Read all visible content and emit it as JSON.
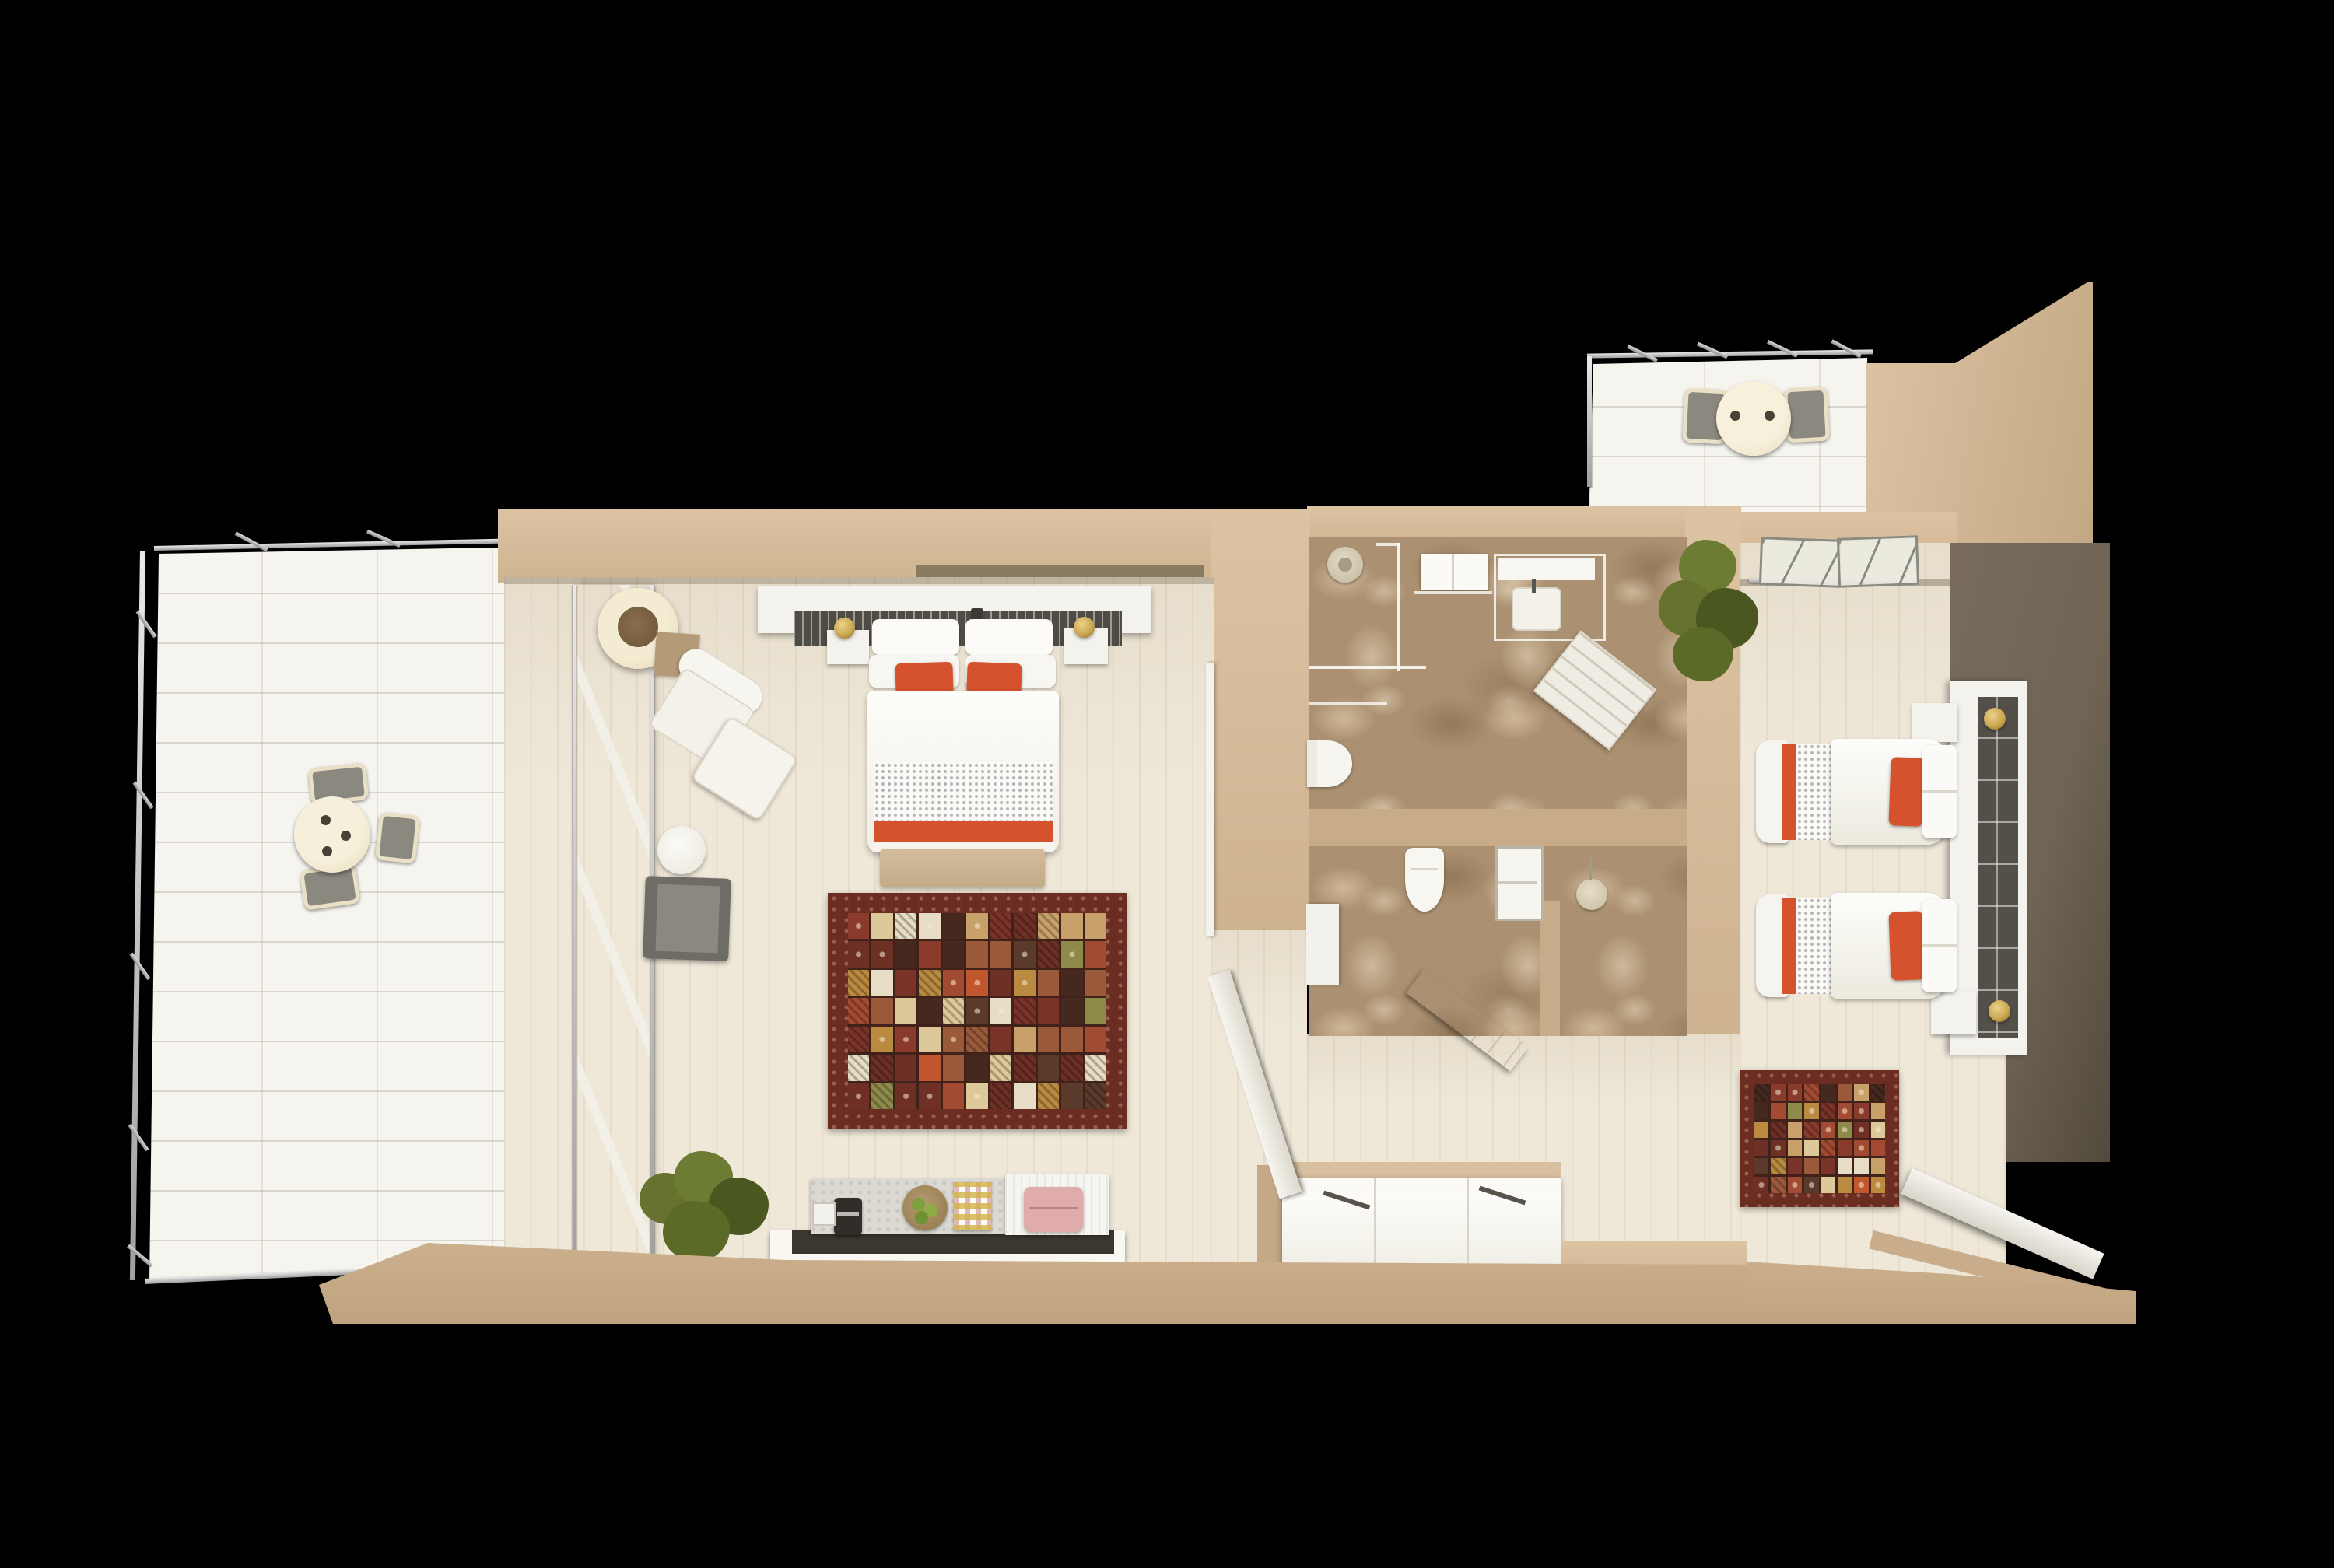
{
  "scene": {
    "background": "#000000",
    "type": "3d-floorplan-render",
    "unit": "hotel-suite-top-view"
  },
  "palette": {
    "bg": "#000000",
    "wall": "#cfb391",
    "wallLight": "#dcc3a2",
    "wallDark": "#bb9f7e",
    "wallShadow": "#8a7a60",
    "floor": "#efe8d9",
    "tile": "#f6f4ee",
    "marble": "#ab9171",
    "taupe": "#6f6455",
    "taupeDark": "#524a3c",
    "white": "#f4f2ec",
    "accent": "#d4532e",
    "runner": "#4f4c45",
    "gray": "#8b8880",
    "gold": "#c8a34c",
    "green": "#66722d",
    "greenDark": "#4b5720",
    "pink": "#dfabab",
    "darkMat": "#3b362e",
    "rugBorder": "#6b2d22",
    "rugGap": "#40221a"
  },
  "rug_main": {
    "cols": 11,
    "rows": 7,
    "seed": 7,
    "tile_colors": [
      "#8a3b2c",
      "#a34a32",
      "#6e2f24",
      "#c7a06a",
      "#b98a3f",
      "#8e8a4a",
      "#e7dcc4",
      "#45291f",
      "#9a5a3a",
      "#7a3328",
      "#5a3a2a",
      "#c2572f",
      "#ddc89a"
    ]
  },
  "rug_small": {
    "cols": 8,
    "rows": 6,
    "seed": 13,
    "tile_colors": [
      "#8a3b2c",
      "#a34a32",
      "#6e2f24",
      "#c7a06a",
      "#b98a3f",
      "#8e8a4a",
      "#e7dcc4",
      "#45291f",
      "#9a5a3a",
      "#7a3328",
      "#5a3a2a",
      "#c2572f",
      "#ddc89a"
    ]
  }
}
